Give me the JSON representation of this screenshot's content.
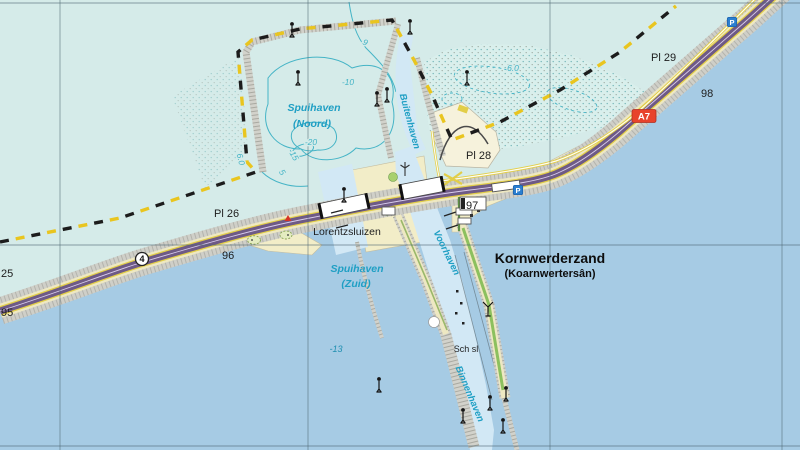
{
  "map": {
    "colors": {
      "water_shallow": "#d5ebe9",
      "water_deep": "#a6cbe4",
      "channel": "#d2e8f5",
      "land_tan": "#f2edc8",
      "land_green": "#a8d06e",
      "breakwater_grey": "#d2d2cb",
      "road_purple": "#6e5a86",
      "road_yellow": "#e2ce48",
      "cable_yellow": "#e9c51f",
      "cable_black": "#1c1c1c",
      "label_cyan": "#1f9fc4",
      "contour_cyan": "#45b4c6",
      "shield_red": "#e8432c",
      "parking_blue": "#2b7fd0",
      "grid": "#4d6672"
    },
    "grid": {
      "vertical": [
        60,
        308,
        550,
        782
      ],
      "horizontal": [
        3,
        245,
        446
      ]
    },
    "labels": [
      {
        "text": "Spuihaven",
        "x": 314,
        "y": 111,
        "kind": "water"
      },
      {
        "text": "(Noord)",
        "x": 312,
        "y": 127,
        "kind": "water"
      },
      {
        "text": "Spuihaven",
        "x": 357,
        "y": 272,
        "kind": "water"
      },
      {
        "text": "(Zuid)",
        "x": 356,
        "y": 287,
        "kind": "water"
      },
      {
        "text": "Buitenhaven",
        "x": 407,
        "y": 122,
        "kind": "water-sm",
        "rot": 75
      },
      {
        "text": "Voorhaven",
        "x": 444,
        "y": 254,
        "kind": "water-sm",
        "rot": 64
      },
      {
        "text": "Binnenhaven",
        "x": 467,
        "y": 395,
        "kind": "water-sm",
        "rot": 67
      },
      {
        "text": "Kornwerderzand",
        "x": 550,
        "y": 263,
        "kind": "town"
      },
      {
        "text": "(Koarnwertersân)",
        "x": 550,
        "y": 277,
        "kind": "town-sub"
      },
      {
        "text": "Lorentzsluizen",
        "x": 347,
        "y": 235,
        "kind": "place"
      },
      {
        "text": "Sch sl",
        "x": 466,
        "y": 352,
        "kind": "place-sm"
      },
      {
        "text": "-10",
        "x": 348,
        "y": 85,
        "kind": "depth"
      },
      {
        "text": "-20",
        "x": 311,
        "y": 145,
        "kind": "depth"
      },
      {
        "text": "-15",
        "x": 291,
        "y": 156,
        "kind": "depth",
        "rot": 60
      },
      {
        "text": "5",
        "x": 280,
        "y": 174,
        "kind": "depth",
        "rot": 55
      },
      {
        "text": "9",
        "x": 364,
        "y": 45,
        "kind": "depth",
        "rot": 25
      },
      {
        "text": "6.0",
        "x": 513,
        "y": 71,
        "kind": "depth"
      },
      {
        "text": "6.0",
        "x": 238,
        "y": 160,
        "kind": "depth",
        "rot": 75
      },
      {
        "text": "-13",
        "x": 336,
        "y": 352,
        "kind": "depth-deep"
      },
      {
        "text": "95",
        "x": 1,
        "y": 316,
        "kind": "km"
      },
      {
        "text": "25",
        "x": 1,
        "y": 277,
        "kind": "km"
      },
      {
        "text": "96",
        "x": 222,
        "y": 259,
        "kind": "km"
      },
      {
        "text": "97",
        "x": 466,
        "y": 209,
        "kind": "km"
      },
      {
        "text": "98",
        "x": 701,
        "y": 97,
        "kind": "km"
      },
      {
        "text": "Pl 26",
        "x": 214,
        "y": 217,
        "kind": "km"
      },
      {
        "text": "Pl 28",
        "x": 466,
        "y": 159,
        "kind": "km"
      },
      {
        "text": "Pl 29",
        "x": 651,
        "y": 61,
        "kind": "km"
      }
    ],
    "road_shields": {
      "motorway": {
        "label": "A7",
        "x": 644,
        "y": 116
      },
      "regional": {
        "label": "4",
        "x": 142,
        "y": 259
      }
    },
    "parking_label": "P",
    "parking_icons": [
      {
        "x": 518,
        "y": 190
      },
      {
        "x": 732,
        "y": 22
      }
    ],
    "beacons": [
      {
        "x": 292,
        "y": 37
      },
      {
        "x": 298,
        "y": 85
      },
      {
        "x": 377,
        "y": 106
      },
      {
        "x": 387,
        "y": 102
      },
      {
        "x": 344,
        "y": 202
      },
      {
        "x": 410,
        "y": 34
      },
      {
        "x": 467,
        "y": 85
      },
      {
        "x": 379,
        "y": 392
      },
      {
        "x": 463,
        "y": 423
      },
      {
        "x": 490,
        "y": 410
      },
      {
        "x": 506,
        "y": 401
      },
      {
        "x": 503,
        "y": 433
      }
    ],
    "forked_beacons": [
      {
        "x": 488,
        "y": 316
      }
    ],
    "wind_turbines": [
      {
        "x": 405,
        "y": 176
      }
    ],
    "lights": [
      {
        "x": 288,
        "y": 221
      }
    ]
  }
}
